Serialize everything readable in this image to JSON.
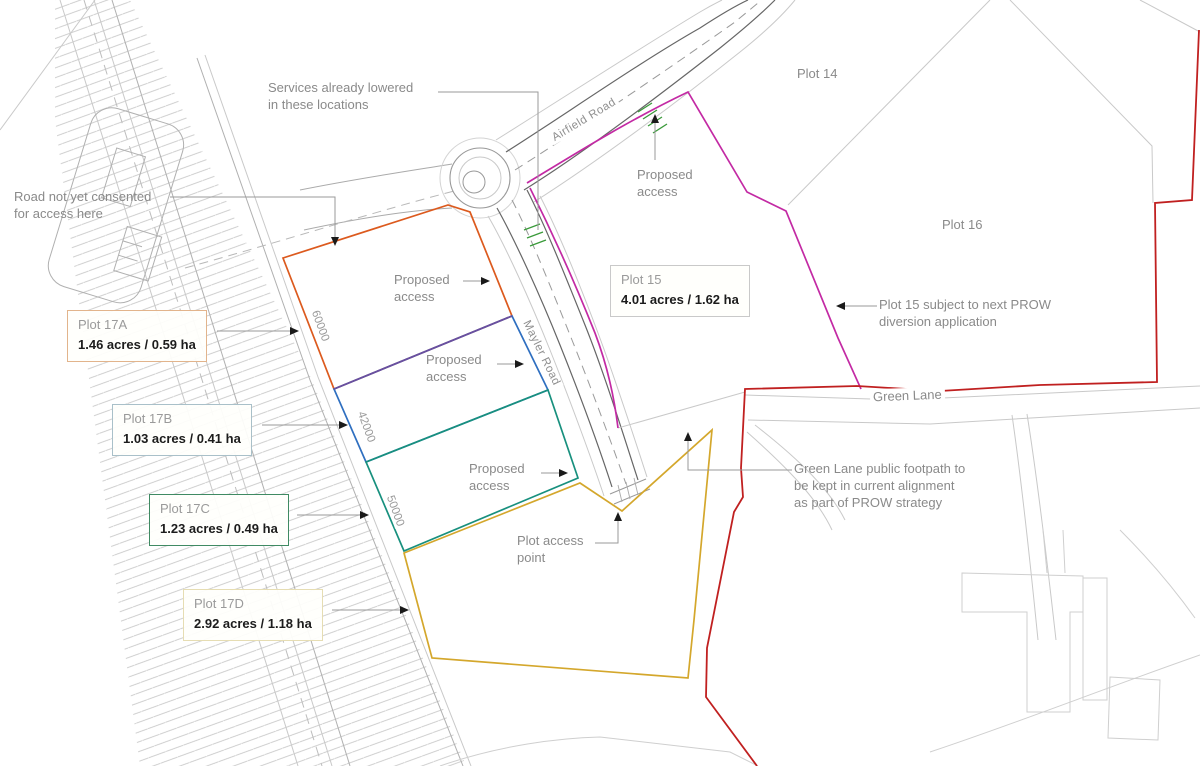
{
  "boxes": {
    "p17a": {
      "title": "Plot 17A",
      "value": "1.46 acres / 0.59 ha",
      "border": "#e2b48c"
    },
    "p17b": {
      "title": "Plot 17B",
      "value": "1.03 acres / 0.41 ha",
      "border": "#a9c0c9"
    },
    "p17c": {
      "title": "Plot 17C",
      "value": "1.23 acres / 0.49 ha",
      "border": "#3f8a63"
    },
    "p17d": {
      "title": "Plot 17D",
      "value": "2.92 acres / 1.18 ha",
      "border": "#e6ddb3"
    },
    "p15": {
      "title": "Plot 15",
      "value": "4.01 acres / 1.62 ha",
      "border": "#c9c9c9"
    }
  },
  "area_labels": {
    "plot14": "Plot 14",
    "plot16": "Plot 16"
  },
  "roads": {
    "airfield": "Airfield Road",
    "mayler": "Mayler Road",
    "greenlane": "Green Lane"
  },
  "notes": {
    "services_1": "Services already lowered",
    "services_2": "in these locations",
    "consent_1": "Road not yet consented",
    "consent_2": "for access here",
    "prow_1": "Plot 15 subject to next PROW",
    "prow_2": "diversion application",
    "footpath_1": "Green Lane public footpath to",
    "footpath_2": "be kept in current alignment",
    "footpath_3": "as part of PROW strategy",
    "access_point_1": "Plot access",
    "access_point_2": "point",
    "proposed_1": "Proposed",
    "proposed_2": "access"
  },
  "dimensions": {
    "d17a": "60000",
    "d17b": "42000",
    "d17c": "50000"
  },
  "colors": {
    "plot17a": "#dc5a1e",
    "plot17b": "#2f6fc0",
    "plot17ab_shared": "#6a4fa0",
    "plot17c": "#18907e",
    "plot17d": "#d4a72c",
    "plot15": "#c32aa4",
    "site_boundary": "#c02020",
    "access_marking": "#3a9a3a",
    "existing_linework": "#c9c9c9",
    "road_kerb": "#666666",
    "annotation_text": "#8a8a8a"
  }
}
